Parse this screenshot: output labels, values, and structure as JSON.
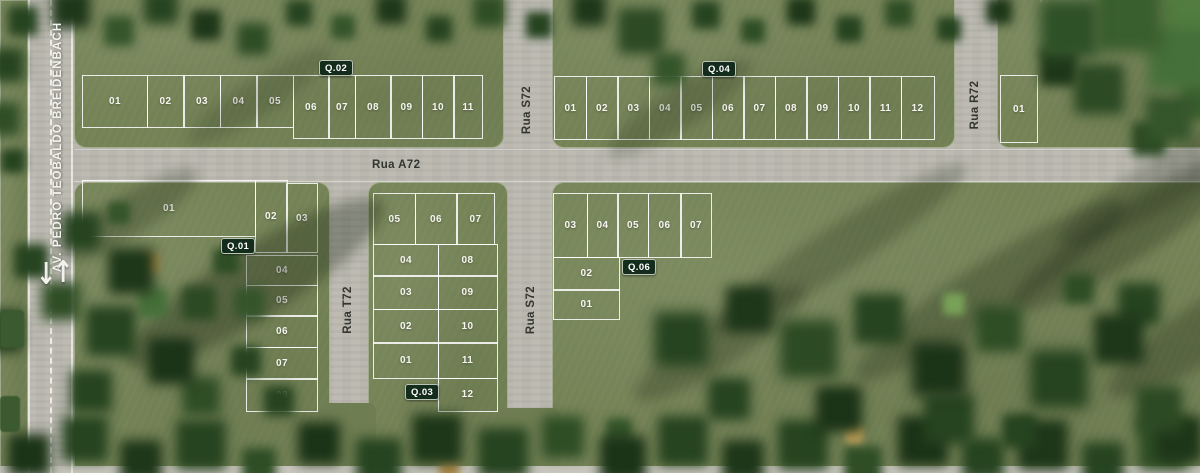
{
  "avenue": {
    "label": "AV. PEDRO TEOBALDO BREIDENBACH"
  },
  "streets": {
    "a72": "Rua A72",
    "s72": "Rua S72",
    "t72": "Rua T72",
    "r72": "Rua R72"
  },
  "arrows": {
    "down": "↓",
    "up": "↑"
  },
  "blocks": {
    "q01": {
      "badge": "Q.01",
      "lots": [
        "01",
        "02",
        "03",
        "04",
        "05",
        "06",
        "07",
        "08"
      ]
    },
    "q02": {
      "badge": "Q.02",
      "lots": [
        "01",
        "02",
        "03",
        "04",
        "05",
        "06",
        "07",
        "08",
        "09",
        "10",
        "11"
      ]
    },
    "q03": {
      "badge": "Q.03",
      "lots": [
        "01",
        "02",
        "03",
        "04",
        "05",
        "06",
        "07",
        "08",
        "09",
        "10",
        "11",
        "12"
      ]
    },
    "q04": {
      "badge": "Q.04",
      "lots": [
        "01",
        "02",
        "03",
        "04",
        "05",
        "06",
        "07",
        "08",
        "09",
        "10",
        "11",
        "12"
      ]
    },
    "q06": {
      "badge": "Q.06",
      "lots": [
        "01",
        "02",
        "03",
        "04",
        "05",
        "06",
        "07"
      ]
    },
    "r72": {
      "lots": [
        "01"
      ]
    }
  },
  "colors": {
    "badge_bg": "#142c1c",
    "road": "#bdbbb2",
    "grass": "#748356",
    "lot_line": "#ffffff",
    "street_text": "#33352f"
  }
}
